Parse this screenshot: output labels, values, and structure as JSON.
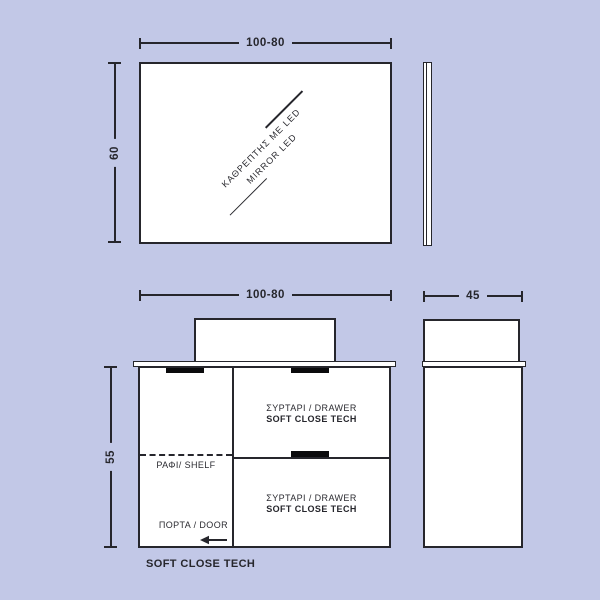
{
  "theme": {
    "background": "#c2c8e7",
    "line": "#26262c",
    "panel_fill": "#ffffff",
    "handle": "#0a0a0c",
    "text": "#2b2b31"
  },
  "mirror_front": {
    "width_dim": "100-80",
    "height_dim": "60",
    "label_line1": "ΚΑΘΡΕΠΤΗΣ ΜΕ LED",
    "label_line2": "MIRROR LED"
  },
  "cabinet_front": {
    "width_dim": "100-80",
    "height_dim": "55",
    "top_drawer": {
      "name": "ΣΥΡΤΑΡΙ / DRAWER",
      "feature": "SOFT CLOSE TECH"
    },
    "bottom_drawer": {
      "name": "ΣΥΡΤΑΡΙ / DRAWER",
      "feature": "SOFT CLOSE TECH"
    },
    "shelf_label": "ΡΑΦΙ/ SHELF",
    "door_label": "ΠΟΡΤΑ / DOOR",
    "footnote": "SOFT CLOSE TECH"
  },
  "cabinet_side": {
    "depth_dim": "45"
  }
}
